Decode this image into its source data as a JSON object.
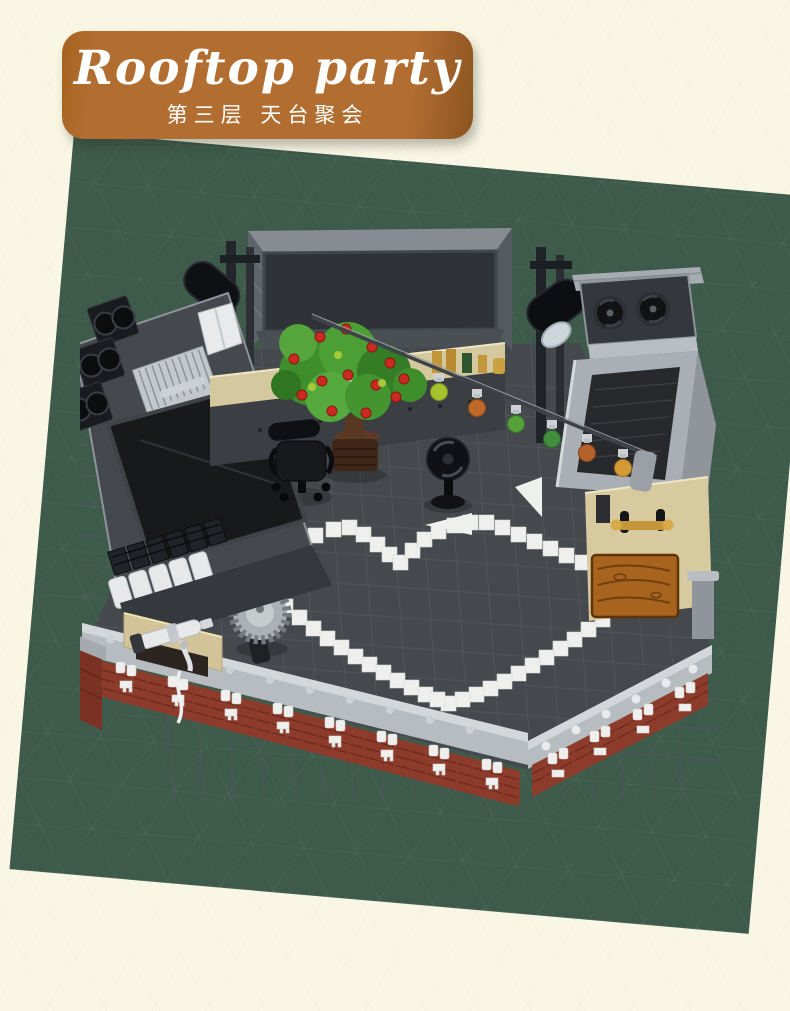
{
  "theme": {
    "--page-bg": "#faf6e4",
    "--panel-green": "#3d5a4b",
    "--banner-bg": "#b26e31",
    "--banner-edge": "#8f5621",
    "--banner-text": "#ffffff"
  },
  "banner": {
    "title": "Rooftop party",
    "subtitle": "第三层 天台聚会"
  },
  "palette": {
    "roof_floor": "#45494d",
    "heart_tile": "#eff0ee",
    "brick_red": "#8d3b2b",
    "parapet_gray": "#b7bcc0",
    "structure_dark": "#3a3e43",
    "black_parts": "#17181a",
    "tan_wall": "#d6ca9e",
    "wood_table": "#a8641f",
    "brass": "#c1953a",
    "tree_green": "#4da237",
    "fruit_red": "#cc2a22",
    "lantern_colors": [
      "#a6c130",
      "#c06828",
      "#55a03a",
      "#3f8f3f",
      "#b5622a",
      "#d29a35"
    ]
  }
}
